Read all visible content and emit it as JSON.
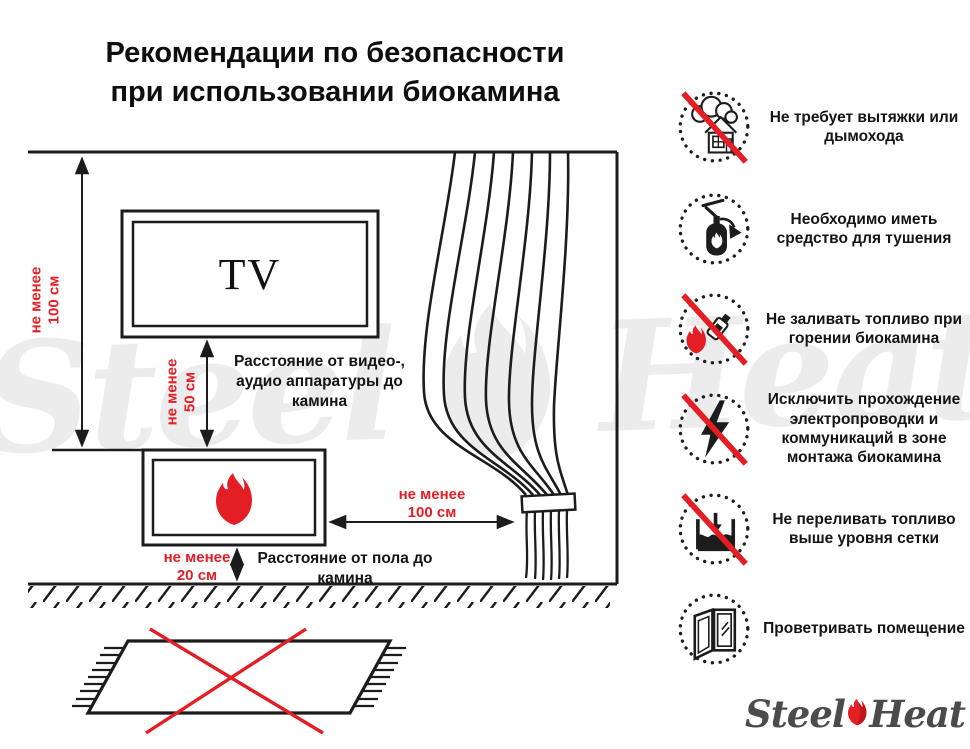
{
  "title": {
    "line1": "Рекомендации по безопасности",
    "line2": "при использовании биокамина"
  },
  "diagram": {
    "tv_label": "TV",
    "wall_distance": {
      "line1": "не менее",
      "line2": "100 см"
    },
    "tv_distance": {
      "line1": "не менее",
      "line2": "50 см"
    },
    "tv_distance_caption": "Расстояние от видео-, аудио аппаратуры до камина",
    "floor_distance": {
      "line1": "не менее",
      "line2": "20 см"
    },
    "floor_distance_caption": "Расстояние от пола до камина",
    "curtain_distance": {
      "line1": "не менее",
      "line2": "100 см"
    }
  },
  "safety": {
    "items": [
      {
        "icon": "no-chimney-icon",
        "text": "Не требует вытяжки или дымохода"
      },
      {
        "icon": "extinguisher-icon",
        "text": "Необходимо иметь средство для тушения"
      },
      {
        "icon": "no-refueling-icon",
        "text": "Не заливать топливо при горении биокамина"
      },
      {
        "icon": "no-wiring-icon",
        "text": "Исключить прохождение электропроводки и коммуникаций в зоне монтажа биокамина"
      },
      {
        "icon": "no-overfill-icon",
        "text": "Не переливать топливо выше уровня сетки"
      },
      {
        "icon": "ventilation-icon",
        "text": "Проветривать помещение"
      }
    ]
  },
  "watermark": {
    "word1": "Steel",
    "word2": "Heat"
  },
  "logo": {
    "word1": "Steel",
    "word2": "Heat"
  },
  "colors": {
    "accent_red": "#e31e24",
    "line_black": "#1c1c1c",
    "watermark_gray": "#ececec",
    "logo_gray": "#4b4b4b"
  }
}
